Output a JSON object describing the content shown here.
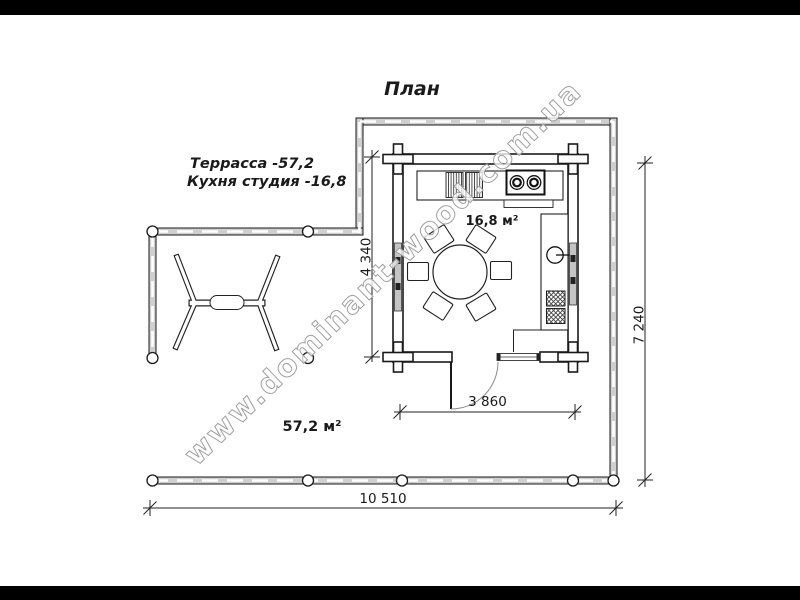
{
  "title": "План",
  "legend": {
    "terrace_line": "Террасса -57,2",
    "kitchen_line": "Кухня студия -16,8"
  },
  "room_labels": {
    "kitchen_area": "16,8 м²",
    "terrace_area": "57,2 м²"
  },
  "dimensions": {
    "kitchen_depth": "4 340",
    "kitchen_width": "3 860",
    "plan_height": "7 240",
    "plan_width": "10 510"
  },
  "watermark": "www.dominant-wood.com.ua",
  "colors": {
    "ink": "#1a1a1a",
    "railing_fill": "#cfcfcf",
    "window_fill": "#c4c4c4",
    "watermark_stroke": "#a0a0a0",
    "letterbox": "#000000",
    "paper": "#ffffff"
  }
}
